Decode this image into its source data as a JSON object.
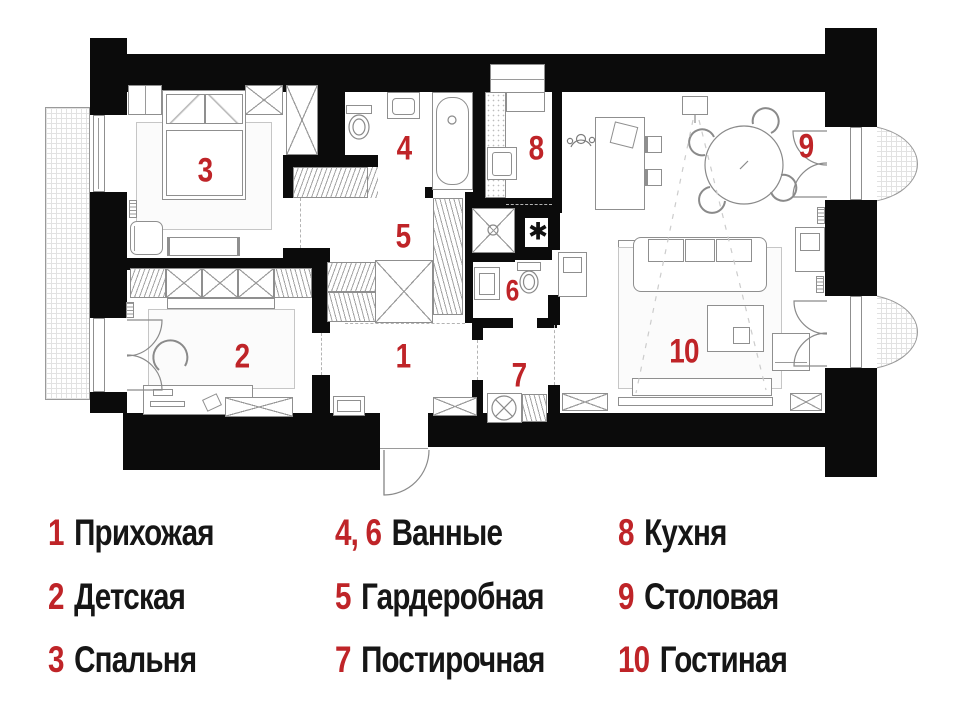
{
  "colors": {
    "accent": "#bf2428",
    "ink": "#161616",
    "wall": "#0b0b0b",
    "line": "#8f8f8f"
  },
  "plan": {
    "markers": [
      {
        "num": "1",
        "room": "hallway"
      },
      {
        "num": "2",
        "room": "children-room"
      },
      {
        "num": "3",
        "room": "bedroom"
      },
      {
        "num": "4",
        "room": "bathroom-1"
      },
      {
        "num": "5",
        "room": "wardrobe"
      },
      {
        "num": "6",
        "room": "bathroom-2"
      },
      {
        "num": "7",
        "room": "laundry"
      },
      {
        "num": "8",
        "room": "kitchen"
      },
      {
        "num": "9",
        "room": "dining"
      },
      {
        "num": "10",
        "room": "living-room"
      }
    ],
    "asterisk": "✱"
  },
  "legend": {
    "columns": [
      {
        "items": [
          {
            "num": "1",
            "label": "Прихожая"
          },
          {
            "num": "2",
            "label": "Детская"
          },
          {
            "num": "3",
            "label": "Спальня"
          }
        ]
      },
      {
        "items": [
          {
            "num": "4, 6",
            "label": "Ванные"
          },
          {
            "num": "5",
            "label": "Гардеробная"
          },
          {
            "num": "7",
            "label": "Постирочная"
          }
        ]
      },
      {
        "items": [
          {
            "num": "8",
            "label": "Кухня"
          },
          {
            "num": "9",
            "label": "Столовая"
          },
          {
            "num": "10",
            "label": "Гостиная"
          }
        ]
      }
    ]
  }
}
